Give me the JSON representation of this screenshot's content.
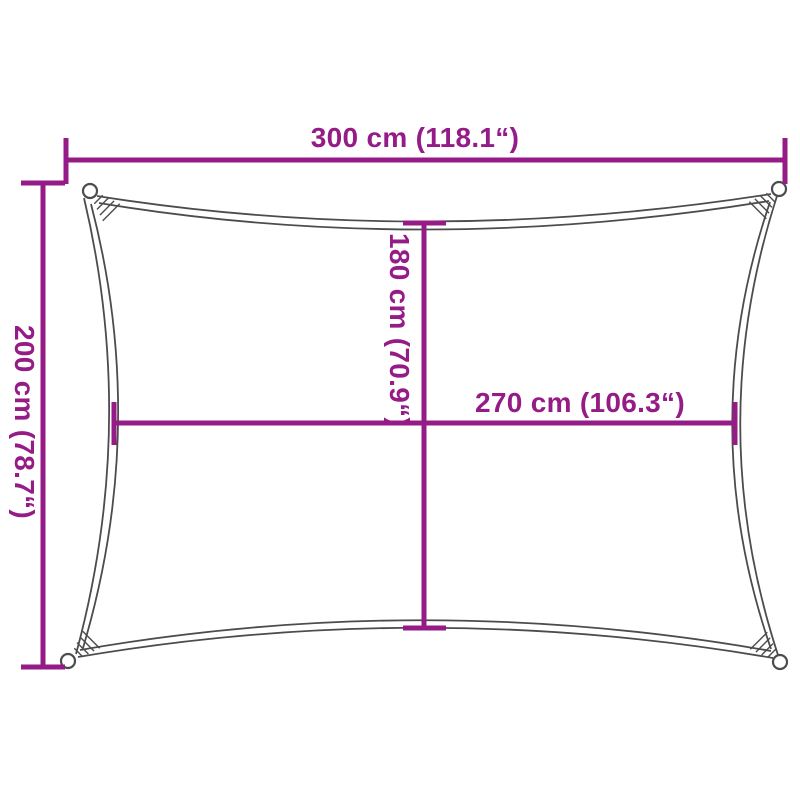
{
  "diagram": {
    "title": "shade-sail-dimension-diagram",
    "dimensions": {
      "width_top": "300 cm (118.1“)",
      "height_left": "200 cm (78.7“)",
      "inner_height": "180 cm (70.9“)",
      "inner_width": "270 cm (106.3“)"
    }
  },
  "colors": {
    "accent": "#951b87",
    "outline": "#4c4c4e",
    "bg": "#ffffff"
  }
}
